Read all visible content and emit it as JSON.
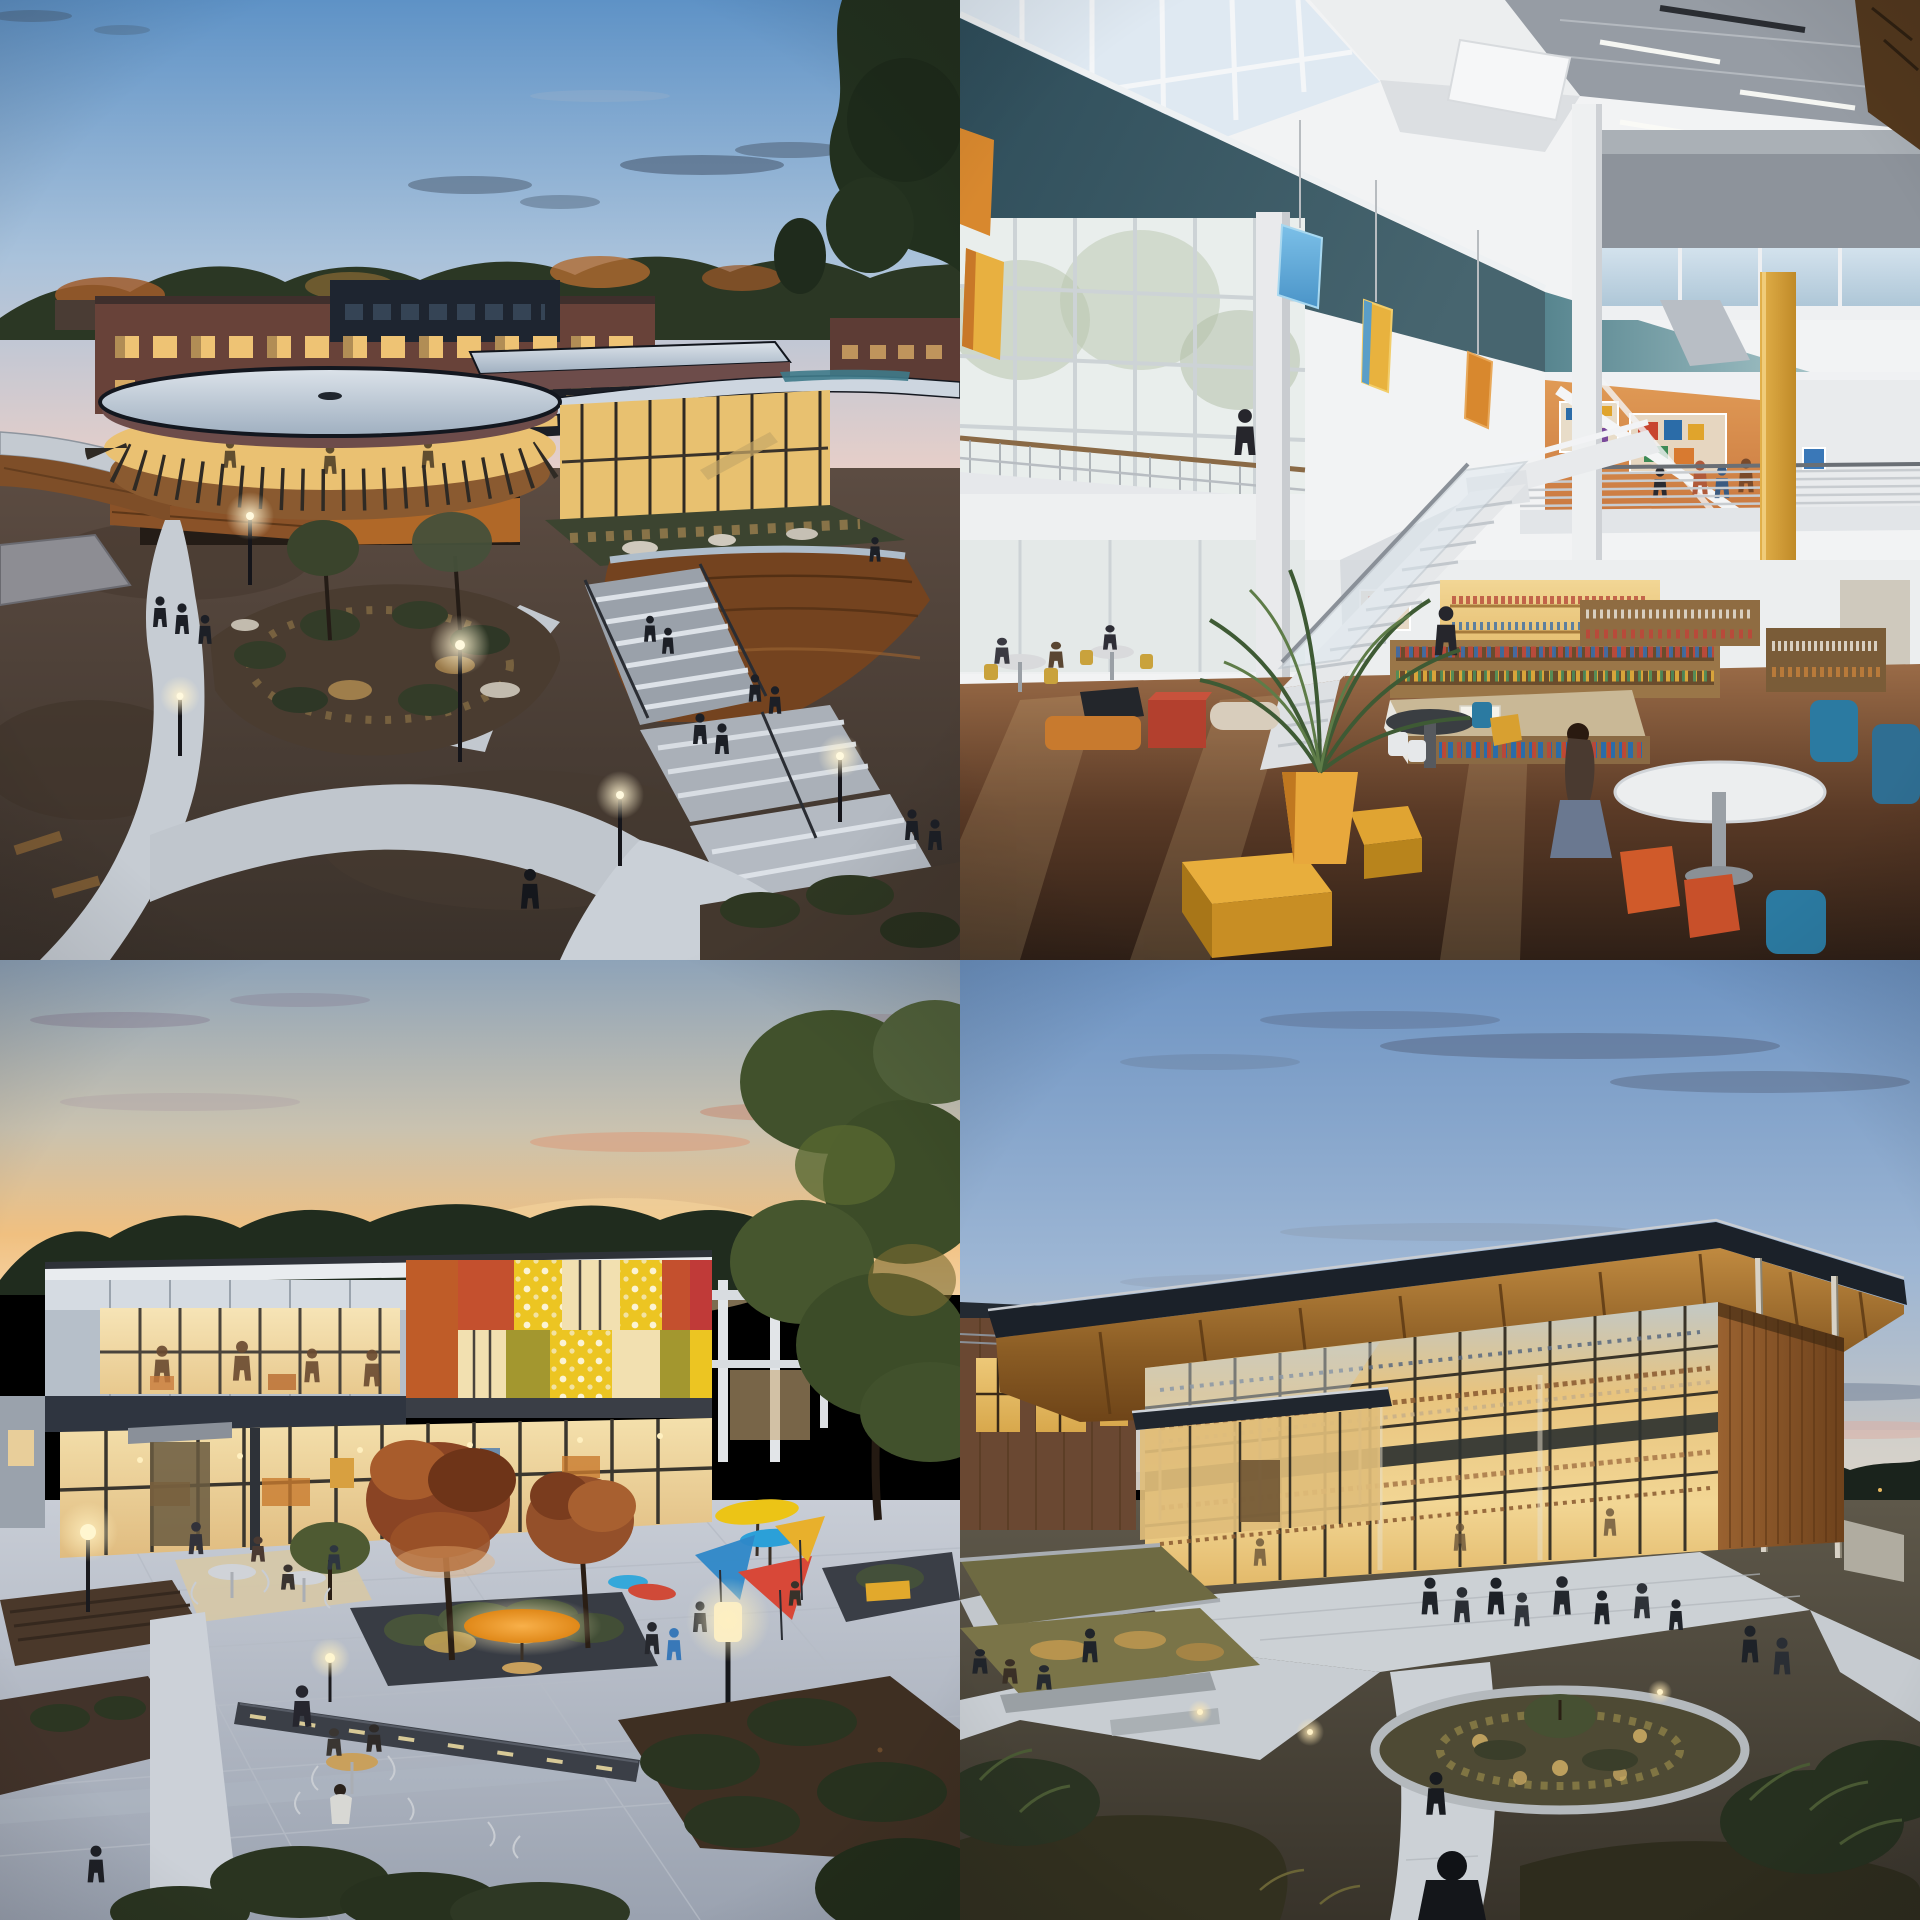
{
  "page": {
    "kind": "generated-image-grid",
    "description": "A 2x2 grid of four architectural concept photographs of a modern community library campus, filling the whole frame with no surrounding interface chrome, menus or text.",
    "grid": {
      "rows": 2,
      "cols": 2,
      "tile_width_px": 960,
      "tile_height_px": 960,
      "gap_px": 0
    }
  },
  "photos": [
    {
      "id": "exterior-aerial-dusk",
      "grid_position": "top-left",
      "time_of_day": "dusk",
      "alt": "Elevated dusk view of a curved modern library with a round white roof and a glowing ribbon of glass, a long sweeping wing, a timber hull-shaped volume and wide lit stairs, set in native plantings with winding concrete paths, path lights and small figures walking; an older brick school building and autumn trees sit behind under a blue-to-pink evening sky.",
      "elements": [
        "curved round-roof pavilion",
        "glowing window band",
        "brick school building",
        "flat-roof glass wing",
        "timber hull volume",
        "green roof terrace",
        "winding paths",
        "outdoor stairs with railings",
        "lamp posts",
        "pedestrians",
        "autumn trees",
        "picnic tables"
      ],
      "palette": {
        "sky_top": "#5E92C6",
        "sky_horizon": "#E7CFC9",
        "cloud": "#47586C",
        "trees": "#2B3724",
        "autumn_foliage": "#A95F2B",
        "brick": "#684239",
        "window_glow": "#EAC172",
        "roof": "#DCE3EA",
        "fascia": "#6D4C4A",
        "timber": "#74431F",
        "ground": "#55463E",
        "path": "#C6CCD3"
      }
    },
    {
      "id": "atrium-interior-day",
      "grid_position": "top-right",
      "time_of_day": "day",
      "alt": "Sunlit two-storey library atrium with a deep teal mezzanine band under clerestory glass, white structural columns and one ochre-yellow column, colorful faceted glass pendants, an open white staircase, an orange mural wall, steel balcony railings with visitors, wood floors, bookshelves full of colorful spines, a potted palm, and yellow, red, orange and blue lounge furniture with a student seated at a round white table.",
      "elements": [
        "teal fascia band",
        "clerestory windows",
        "white columns",
        "yellow column",
        "hanging glass gems",
        "open staircase",
        "mezzanine railings",
        "orange mural wall",
        "bookshelves",
        "potted palm",
        "ottoman cubes",
        "round tables",
        "blue and orange chairs",
        "visitors"
      ],
      "palette": {
        "wall": "#F2F3F4",
        "teal_band": "#2E4D5A",
        "frosted_glass": "#C3D7E5",
        "yellow_column": "#D9A33C",
        "coral_wall": "#CE8355",
        "gem_blue": "#64AEDD",
        "gem_yellow": "#E8B23E",
        "floor_wood": "#6E4C34",
        "ottoman_yellow": "#E0A432",
        "cube_red": "#B3402E",
        "chair_blue": "#2B7AA1",
        "chair_orange": "#D05A2A"
      }
    },
    {
      "id": "courtyard-sunset",
      "grid_position": "bottom-left",
      "time_of_day": "sunset",
      "alt": "Evening view of a two-storey learning center whose upper facade is colorblocked in burnt orange, rust, dotted yellow, olive and red panels over a warmly glowing glass ground floor with people inside; in front, a paved courtyard with charcoal planters, autumn trees, a glowing orange umbrella, yellow, cyan and red shade discs, wire cafe tables with visitors, path lights and dark garden beds under an orange sunset sky.",
      "elements": [
        "colorblock facade panels",
        "dot-frit glazing",
        "glowing ground-floor glass",
        "interior silhouettes",
        "courtyard pavers",
        "charcoal planters",
        "orange umbrella",
        "colored shade discs",
        "wire tables and chairs",
        "autumn trees",
        "tall column lamp",
        "garden beds",
        "pedestrians"
      ],
      "palette": {
        "sky_top": "#8EA3B8",
        "sky_sunset": "#F0C080",
        "trees": "#202C1E",
        "panel_gray": "#B6BFC9",
        "facade_orange": "#BF5C28",
        "facade_rust": "#C4502E",
        "facade_yellow": "#ECC522",
        "facade_olive": "#A3972F",
        "facade_red": "#C03A38",
        "glass_glow": "#F2DDAB",
        "paver": "#C8CDD6",
        "planter": "#3A3E46",
        "umbrella_orange": "#F09822",
        "umbrella_blue": "#2BA0D8"
      }
    },
    {
      "id": "glass-pavilion-dusk",
      "grid_position": "bottom-right",
      "time_of_day": "dusk",
      "alt": "Dusk photograph of a glass-walled library pavilion beneath a broad cantilevered roof with a warm timber soffit carried on slender columns; the curtain wall glows amber revealing bookshelf-lined floors, a cedar-clad volume anchors the right end and a lower brick wing sits at left; in front, a native garden with a circular concrete-edged planting bed, terraced grasses, winding light paths, visitors strolling and a lone silhouetted figure at the bottom under a wispy blue evening sky.",
      "elements": [
        "cantilevered dark roof",
        "timber soffit with rafters",
        "slender steel columns",
        "glowing glass curtain wall",
        "interior bookshelves",
        "cedar-clad volume",
        "brick side wing",
        "entry canopy",
        "circular planting bed",
        "terraced grass gardens",
        "winding paths",
        "concrete seat walls",
        "strolling visitors",
        "foreground silhouette"
      ],
      "palette": {
        "sky_top": "#6D93C2",
        "cloud_slate": "#5A6A86",
        "cloud_pink": "#D8AFA6",
        "roof": "#1B2129",
        "soffit_timber": "#C08A40",
        "glass_glow": "#E8C47E",
        "cedar": "#8A5526",
        "column": "#D8D2C6",
        "path": "#CCD1D5",
        "curb": "#B4B9BD",
        "grass_olive": "#6E6A40",
        "grass_lit": "#C89C50"
      }
    }
  ]
}
